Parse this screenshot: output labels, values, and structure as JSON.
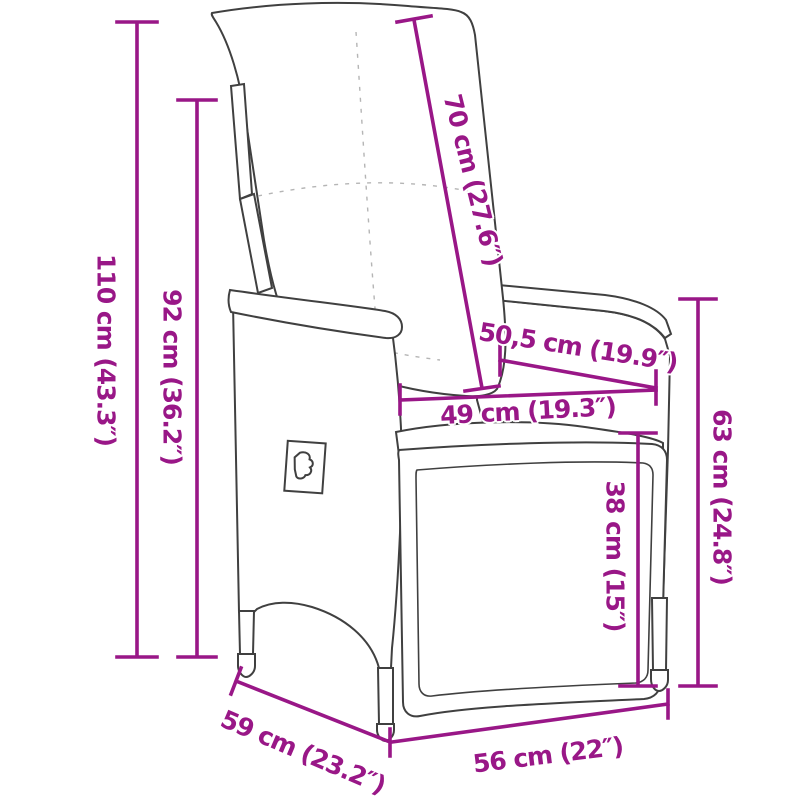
{
  "diagram": {
    "subject": "reclining garden chair with cushions, line drawing with measurements",
    "colors": {
      "dimension": "#991787",
      "outline": "#404040",
      "wicker": "#7a7a7a",
      "background": "#ffffff"
    }
  },
  "dimensions": [
    {
      "id": "total-height",
      "text": "110 cm (43.3″)"
    },
    {
      "id": "frame-height",
      "text": "92 cm (36.2″)"
    },
    {
      "id": "backrest-length",
      "text": "70 cm (27.6″)"
    },
    {
      "id": "backrest-width",
      "text": "50,5 cm (19.9″)"
    },
    {
      "id": "seat-width",
      "text": "49 cm (19.3″)"
    },
    {
      "id": "side-height",
      "text": "63 cm (24.8″)"
    },
    {
      "id": "footrest-height",
      "text": "38 cm (15″)"
    },
    {
      "id": "seat-depth",
      "text": "59 cm (23.2″)"
    },
    {
      "id": "front-width",
      "text": "56 cm (22″)"
    }
  ]
}
